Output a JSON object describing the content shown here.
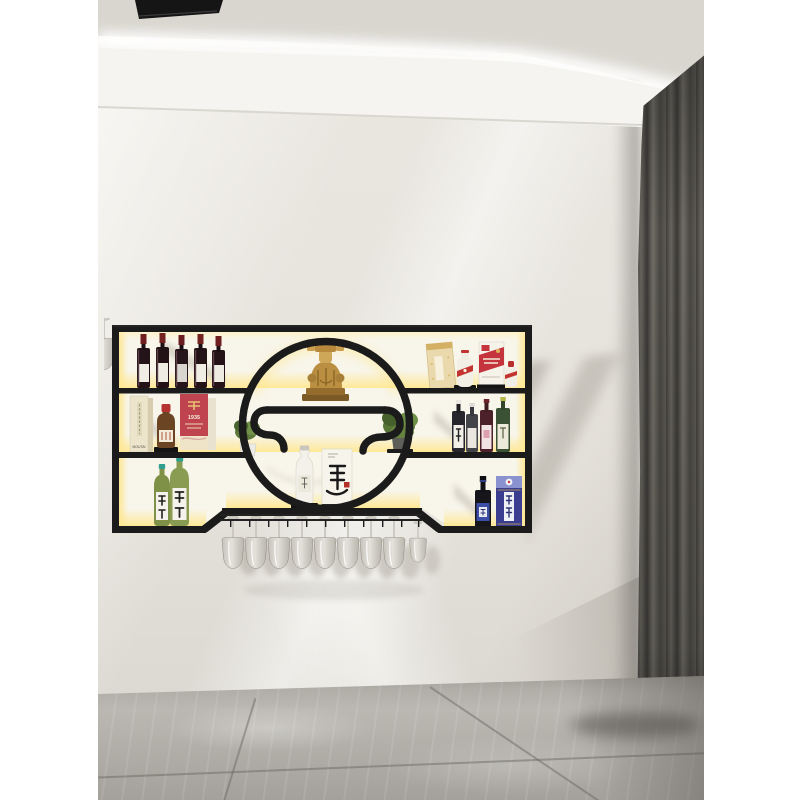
{
  "image": {
    "kind": "interior product photograph",
    "subject": "wall-mounted black metal wine rack with LED backlight, round center opening and hanging stemware",
    "border_color": "#ffffff"
  },
  "room": {
    "wall_color": "#e5e2db",
    "ceiling_color": "#d9d6cf",
    "cove_light_color": "#ffffff",
    "ceiling_vent_color": "#151515",
    "curtain_color": "#56534e",
    "floor_color": "#b3b0aa"
  },
  "rack": {
    "frame_color": "#1b1b1b",
    "led_color": "#ffe88a",
    "hanging_glasses_count": "9",
    "shelves": {
      "left_top": {
        "type": "red wine bottles",
        "count": "5"
      },
      "left_middle": {
        "items": [
          {
            "type": "cream box",
            "label": "MOUTAI"
          },
          {
            "type": "mini brown bottle with red cap"
          },
          {
            "type": "red box",
            "label": "茅台 1935",
            "digits": "1935"
          }
        ]
      },
      "left_bottom": {
        "items": [
          {
            "type": "green sake bottle",
            "label": "天明"
          },
          {
            "type": "green sake bottle",
            "label": "天明"
          }
        ]
      },
      "center": {
        "statue": "gold wealth-god figurine",
        "left_plant": "small white potted plant",
        "right_plant": "leafy potted plant",
        "bottle": "white ceramic liquor bottle",
        "box_label": "董"
      },
      "right_top": {
        "items": [
          {
            "type": "gold gift box"
          },
          {
            "type": "white baijiu bottle with red sash"
          },
          {
            "type": "red-and-white moutai box"
          },
          {
            "type": "small white bottle with red cap"
          }
        ]
      },
      "right_middle": {
        "type": "assorted dark liquor bottles",
        "count": "4"
      },
      "right_bottom": {
        "items": [
          {
            "type": "dark bottle with blue label"
          },
          {
            "type": "blue box",
            "label": "赖茅"
          }
        ]
      }
    }
  }
}
